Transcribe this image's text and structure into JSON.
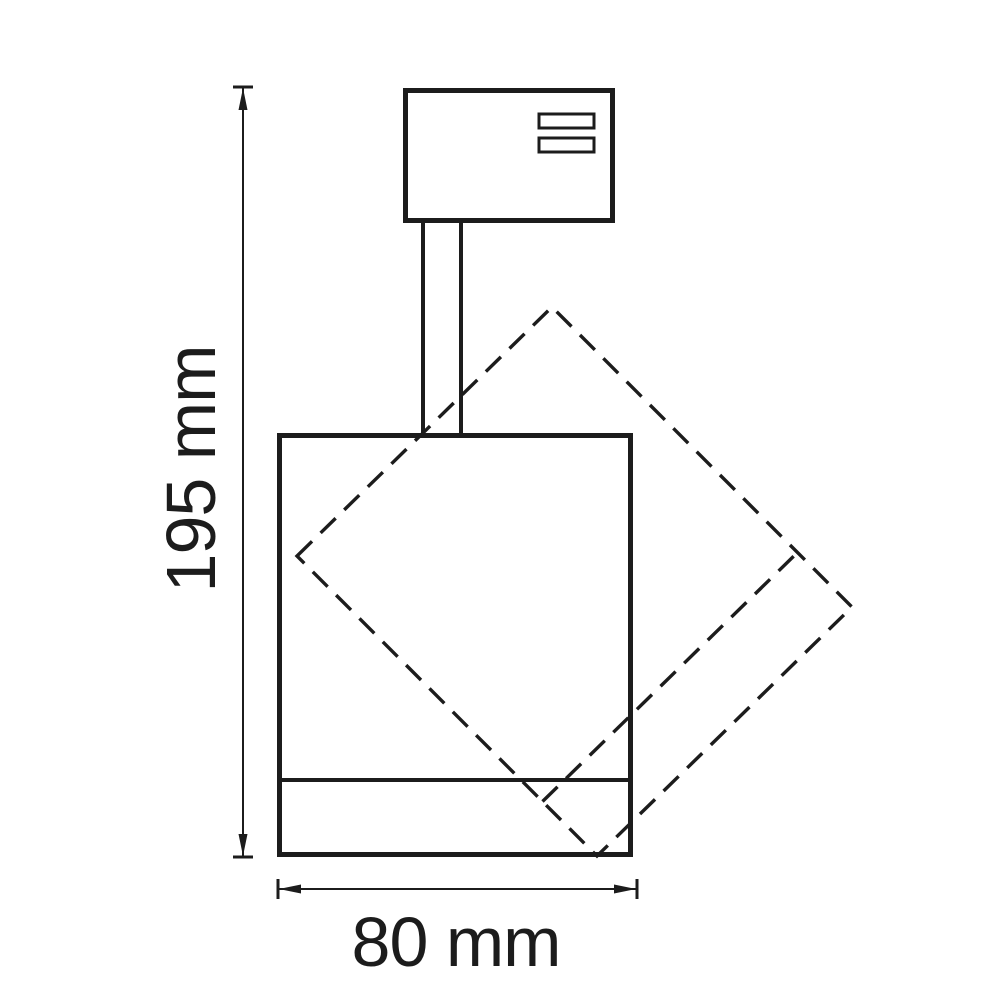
{
  "drawing": {
    "description_labels": {},
    "line_color": "#1c1c1c",
    "background_color": "#ffffff",
    "dimensions": {
      "height": {
        "label": "195 mm",
        "value": 195,
        "unit": "mm"
      },
      "width": {
        "label": "80 mm",
        "value": 80,
        "unit": "mm"
      }
    },
    "parts": {
      "adapter": "track-adapter-box",
      "adapter_slots": 2,
      "stem": "stem",
      "body": "lamp-body",
      "bezel_line": "lamp-bezel-line",
      "rotated_outline": "rotated-body-dashed-outline"
    }
  }
}
